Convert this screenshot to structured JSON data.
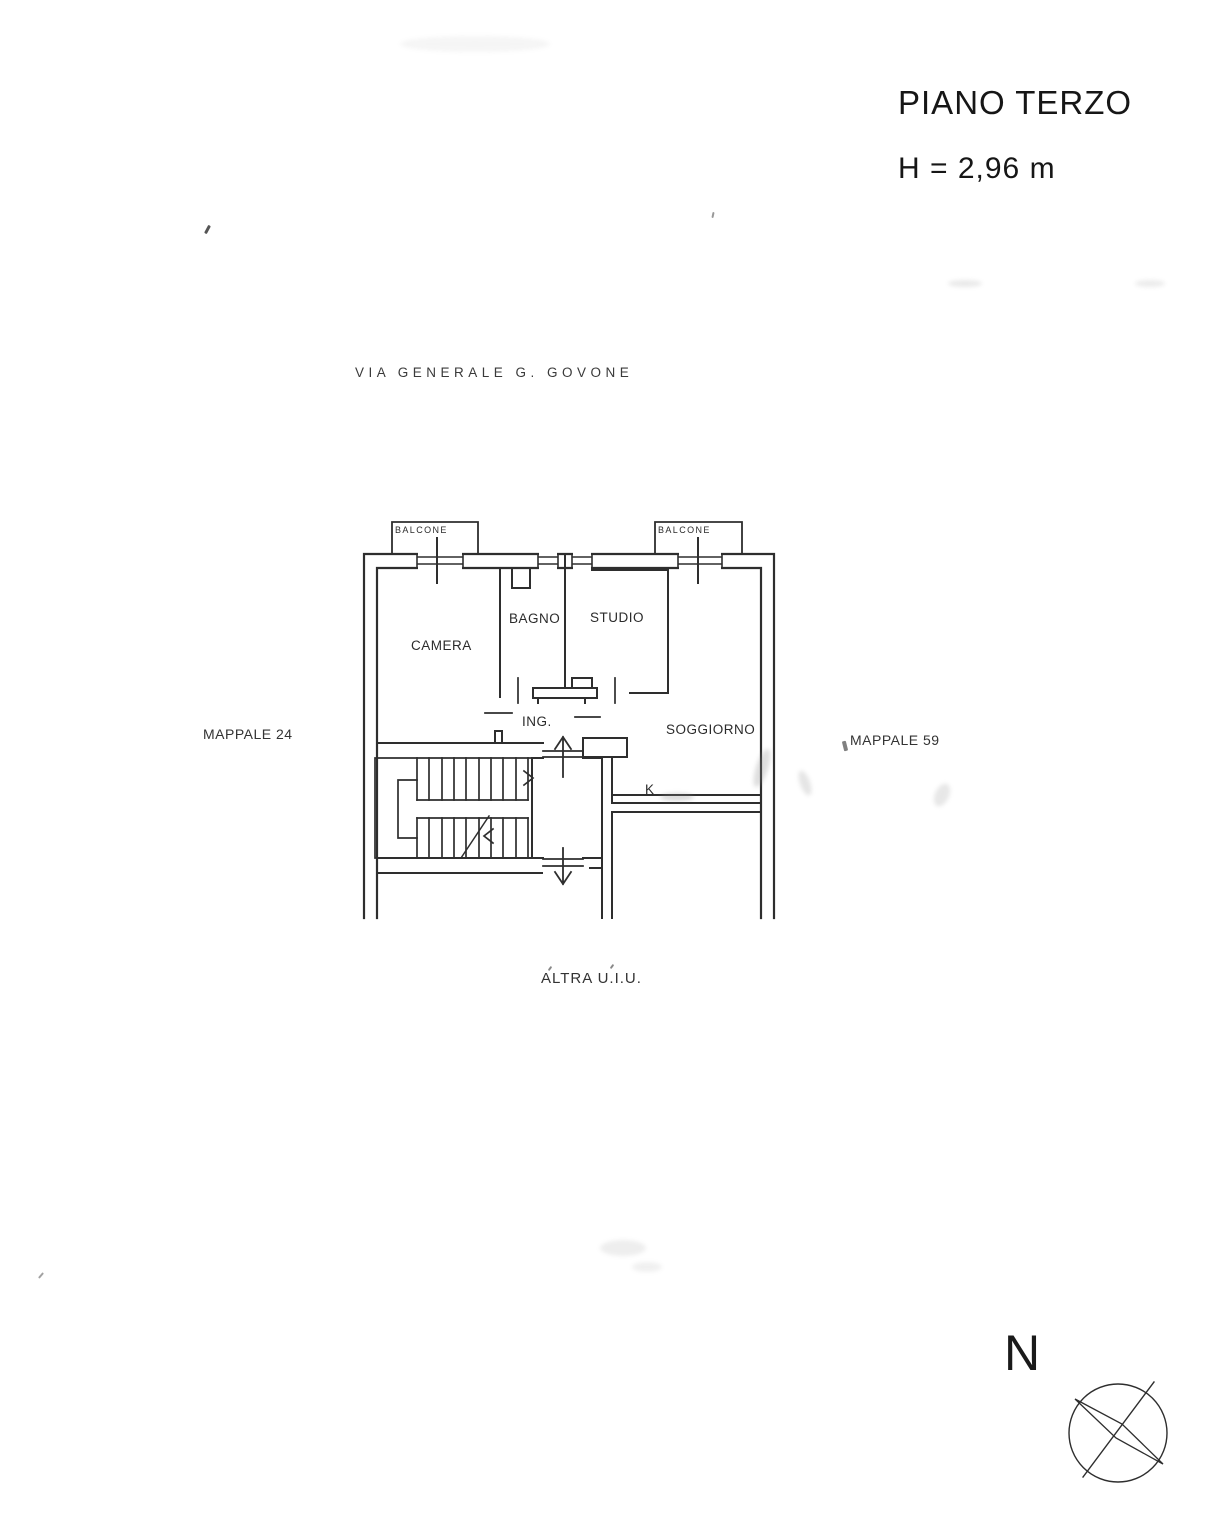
{
  "page": {
    "floor_title": "PIANO TERZO",
    "height_note": "H = 2,96 m",
    "street_label": "VIA  GENERALE  G. GOVONE",
    "parcel_left": "MAPPALE 24",
    "parcel_right": "MAPPALE 59",
    "other_unit_label": "ALTRA U.I.U.",
    "north_letter": "N"
  },
  "plan": {
    "rooms": {
      "balcone_left": "BALCONE",
      "balcone_right": "BALCONE",
      "camera": "CAMERA",
      "bagno": "BAGNO",
      "studio": "STUDIO",
      "ingresso": "ING.",
      "soggiorno": "SOGGIORNO",
      "cucina": "K"
    },
    "colors": {
      "ink": "#2e2e2e",
      "paper": "#ffffff"
    }
  }
}
